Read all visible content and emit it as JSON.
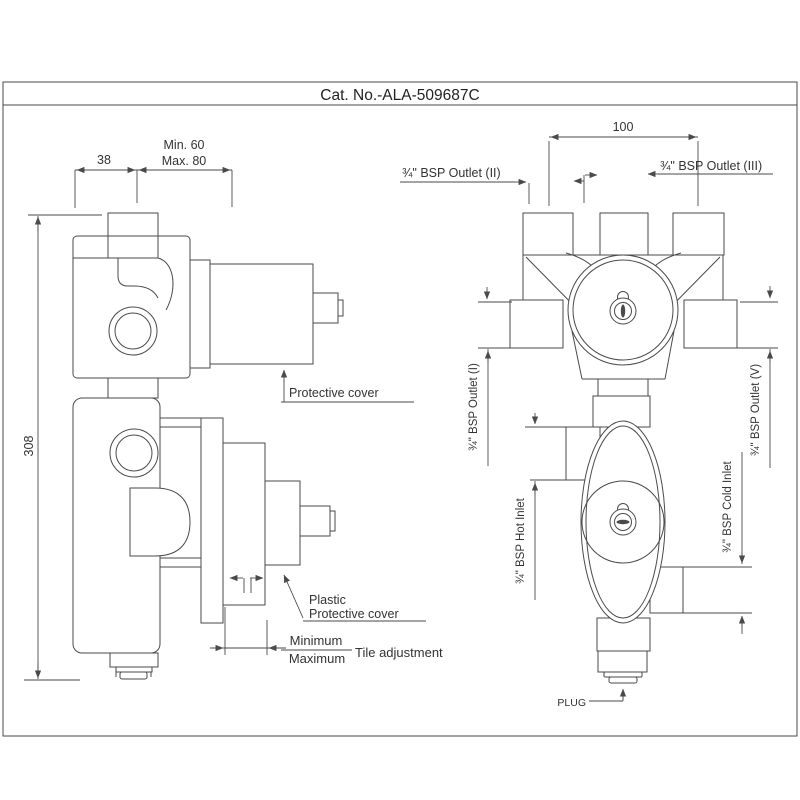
{
  "title": "Cat. No.-ALA-509687C",
  "colors": {
    "line": "#4a4a4a",
    "text": "#333333",
    "background": "#ffffff"
  },
  "left_view": {
    "dim_width_wall": "38",
    "dim_min": "Min. 60",
    "dim_max": "Max. 80",
    "dim_height": "308",
    "protective_cover": "Protective cover",
    "plastic_cover_line1": "Plastic",
    "plastic_cover_line2": "Protective cover",
    "minimum": "Minimum",
    "maximum": "Maximum",
    "tile_adjustment": "Tile adjustment"
  },
  "right_view": {
    "dim_outlet_spacing": "100",
    "outlet_2": "¾\" BSP Outlet (II)",
    "outlet_3": "¾\" BSP Outlet (III)",
    "outlet_1": "¾\" BSP Outlet (I)",
    "outlet_5": "¾\" BSP Outlet (V)",
    "hot_inlet": "¾\" BSP Hot Inlet",
    "cold_inlet": "¾\" BSP Cold Inlet",
    "plug": "PLUG"
  }
}
